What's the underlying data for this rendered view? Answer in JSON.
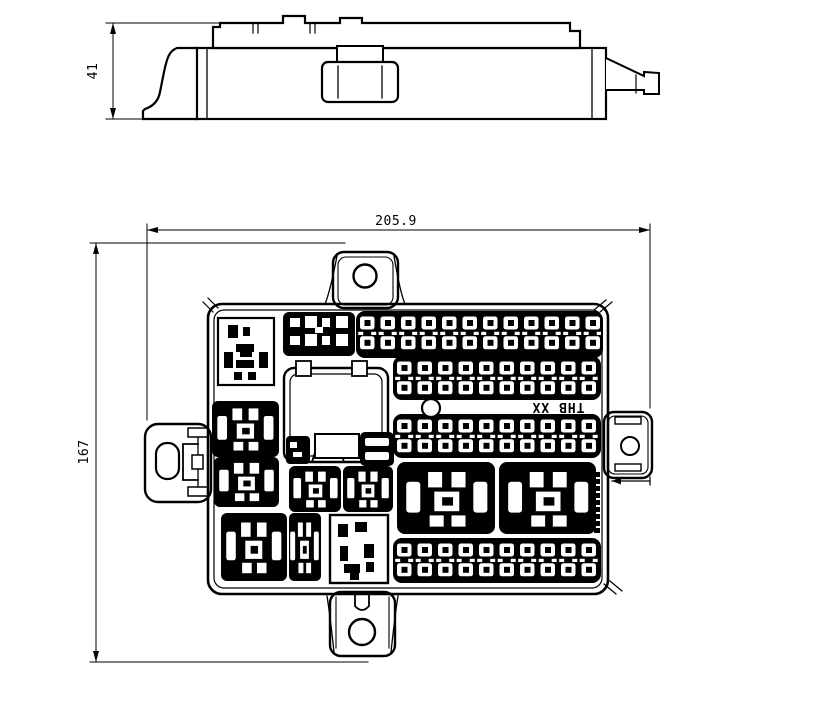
{
  "drawing": {
    "dimensions": {
      "side_height": "41",
      "overall_width": "205.9",
      "overall_height": "167"
    },
    "marking": "THB XX",
    "colors": {
      "line": "#000000",
      "background": "#ffffff"
    }
  }
}
